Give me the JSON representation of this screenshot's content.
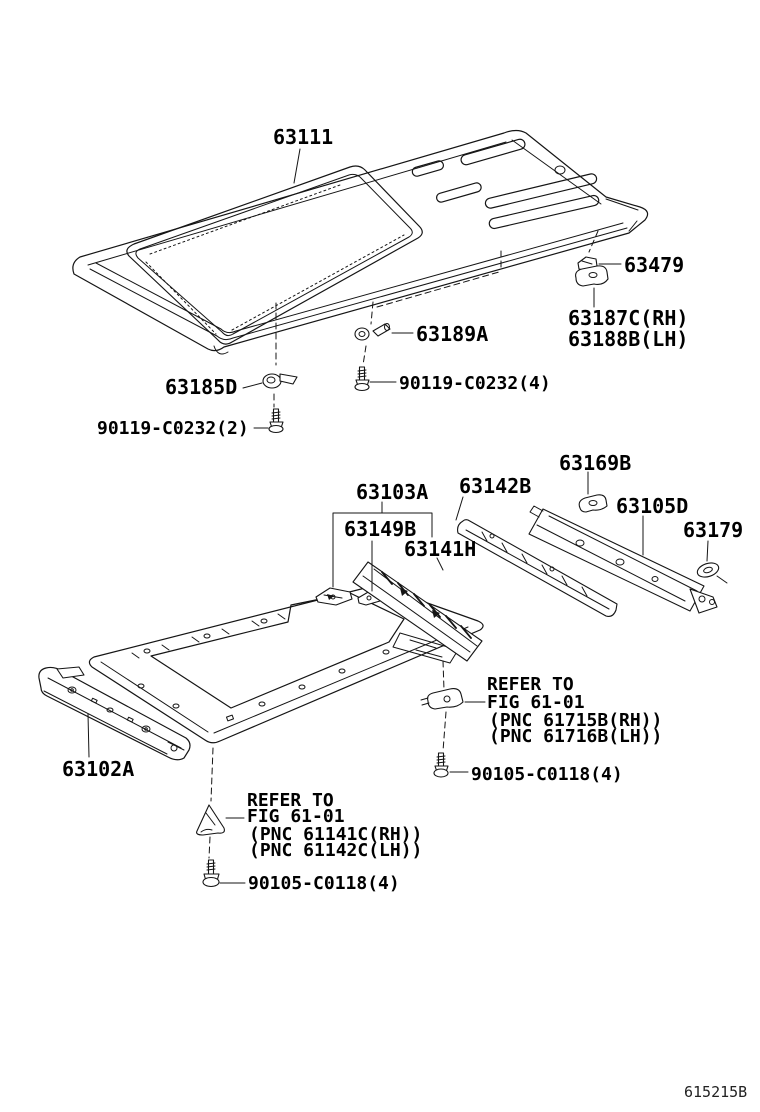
{
  "figure": {
    "code": "615215B"
  },
  "callouts": {
    "roof_panel": "63111",
    "support_63479": "63479",
    "bracket_rh": "63187C(RH)",
    "bracket_lh": "63188B(LH)",
    "hinge_63189a": "63189A",
    "bolt_90119_x4": "90119-C0232(4)",
    "clip_63185d": "63185D",
    "bolt_90119_x2": "90119-C0232(2)",
    "assembly_63103a": "63103A",
    "reinf_63149b": "63149B",
    "rail_63141h": "63141H",
    "strip_63142b": "63142B",
    "clip_63169b": "63169B",
    "rail_63105d": "63105D",
    "grommet_63179": "63179",
    "header_63102a": "63102A",
    "bolt_90105_rear": "90105-C0118(4)",
    "bolt_90105_front": "90105-C0118(4)"
  },
  "notes": {
    "rear": {
      "l1": "REFER TO",
      "l2": "FIG 61-01",
      "l3": "(PNC 61715B(RH))",
      "l4": "(PNC 61716B(LH))"
    },
    "front": {
      "l1": "REFER TO",
      "l2": "FIG 61-01",
      "l3": "(PNC 61141C(RH))",
      "l4": "(PNC 61142C(LH))"
    }
  }
}
